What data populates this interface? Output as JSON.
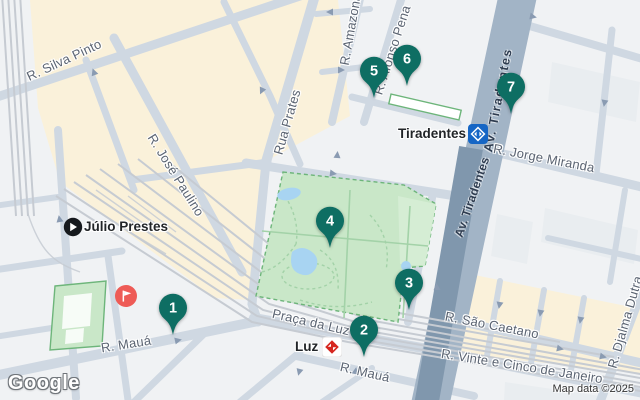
{
  "attribution": {
    "logo": "Google",
    "map_data": "Map data ©2025"
  },
  "markers": [
    {
      "number": "1"
    },
    {
      "number": "2"
    },
    {
      "number": "3"
    },
    {
      "number": "4"
    },
    {
      "number": "5"
    },
    {
      "number": "6"
    },
    {
      "number": "7"
    }
  ],
  "streets": {
    "silva_pinto": "R. Silva Pinto",
    "jose_paulino": "R. José Paulino",
    "rua_prates": "Rua Prates",
    "amazonas": "R. Amazonas",
    "afonso_pena": "R. Afonso Pena",
    "av_tiradentes_upper": "Av. Tiradentes",
    "av_tiradentes_lower": "Av. Tiradentes",
    "jorge_miranda": "R. Jorge Miranda",
    "sao_caetano": "R. São Caetano",
    "vinte_e_cinco": "R. Vinte e Cinco de Janeiro",
    "djalma_dutra": "R. Djalma Dutra",
    "praca_da_luz": "Praça da Luz",
    "maua_west": "R. Mauá",
    "maua_east": "R. Mauá"
  },
  "pois": {
    "julio_prestes": {
      "label": "Júlio Prestes",
      "icon": "train-station-icon"
    },
    "tiradentes_station": {
      "label": "Tiradentes",
      "icon": "metro-icon"
    },
    "luz_station": {
      "label": "Luz",
      "icon": "cptm-train-icon"
    },
    "attraction": {
      "icon": "flag-icon"
    }
  },
  "colors": {
    "bg": "#f0f2f4",
    "block": "#e9edf0",
    "commercial": "#faf1da",
    "road": "#cfd8e2",
    "avenue": "#a2b4c6",
    "rail_corridor": "#8097ad",
    "rail": "#c6cbd2",
    "park": "#c9e7c8",
    "park_light": "#d5edd4",
    "park_path": "#a3d2a8",
    "park_outline": "#6db57a",
    "pond": "#a8d4f2",
    "marker": "#0e6e63",
    "metro_blue": "#1666c5",
    "cptm_red": "#d6261f",
    "attraction_red": "#ee5b56",
    "street_label": "#5b6472",
    "road_label": "#2e3c50",
    "poi_label": "#222528",
    "attribution": "#333333",
    "pin_text": "#ffffff"
  }
}
